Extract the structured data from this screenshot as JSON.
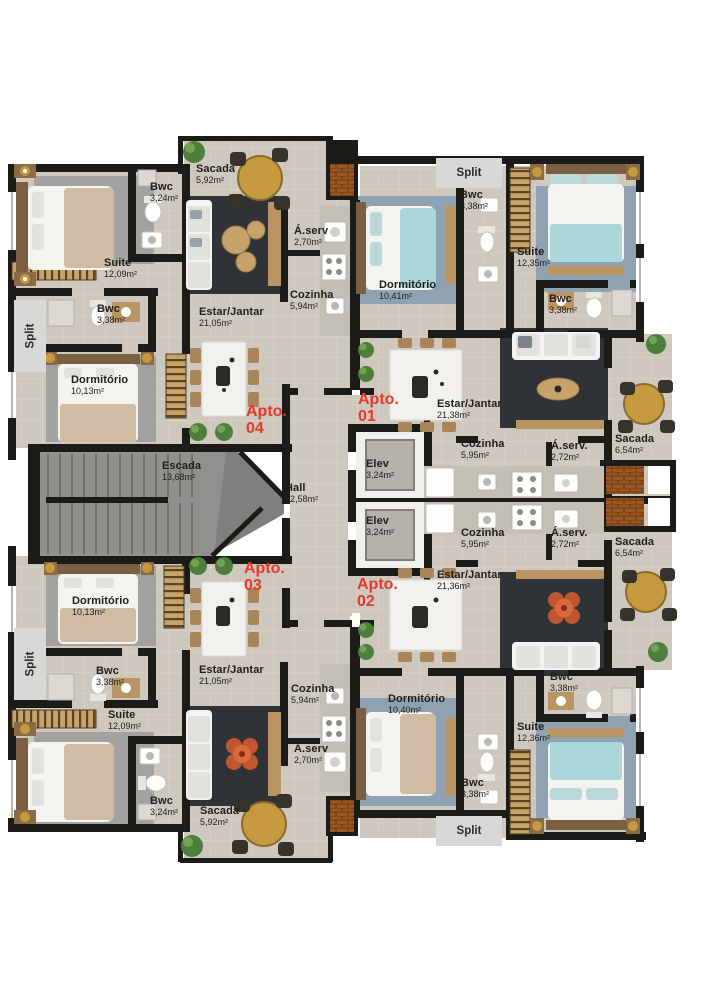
{
  "plan_type": "residential-floor-plan",
  "colors": {
    "wall": "#1b1b18",
    "floor": "#cdc7bd",
    "floor_line": "#dad4ca",
    "accent_red": "#e8372b",
    "living_rug": "#2f3237",
    "bedroom_rug_gray": "#a2a3a0",
    "bedroom_rug_steel": "#8fa2b1",
    "wood": "#b99563",
    "gold": "#c59a3f",
    "teal_bed": "#abd7da",
    "tan_bed": "#cfbca3",
    "stair_gray": "#8e918d",
    "split_box": "#d8d8d6",
    "brick": "#9a5724"
  },
  "apartment_labels": [
    {
      "t": "Apto.",
      "n": "04",
      "x": 246,
      "y": 404
    },
    {
      "t": "Apto.",
      "n": "01",
      "x": 358,
      "y": 392
    },
    {
      "t": "Apto.",
      "n": "03",
      "x": 244,
      "y": 561
    },
    {
      "t": "Apto.",
      "n": "02",
      "x": 357,
      "y": 577
    }
  ],
  "room_labels": [
    {
      "t": "Sacada",
      "a": "5,92m²",
      "x": 196,
      "y": 164
    },
    {
      "t": "Bwc",
      "a": "3,24m²",
      "x": 150,
      "y": 182
    },
    {
      "t": "Suite",
      "a": "12,09m²",
      "x": 104,
      "y": 258
    },
    {
      "t": "Á.serv",
      "a": "2,70m²",
      "x": 294,
      "y": 226
    },
    {
      "t": "Cozinha",
      "a": "5,94m²",
      "x": 290,
      "y": 290
    },
    {
      "t": "Bwc",
      "a": "3,38m²",
      "x": 97,
      "y": 304
    },
    {
      "t": "Estar/Jantar",
      "a": "21,05m²",
      "x": 199,
      "y": 307
    },
    {
      "t": "Dormitório",
      "a": "10,13m²",
      "x": 71,
      "y": 375
    },
    {
      "t": "Escada",
      "a": "13,68m²",
      "x": 162,
      "y": 461
    },
    {
      "t": "Hall",
      "a": "12,58m²",
      "x": 285,
      "y": 483
    },
    {
      "t": "Elev",
      "a": "3,24m²",
      "x": 366,
      "y": 459
    },
    {
      "t": "Elev",
      "a": "3,24m²",
      "x": 366,
      "y": 516
    },
    {
      "t": "Bwc",
      "a": "3,38m²",
      "x": 460,
      "y": 190
    },
    {
      "t": "Suite",
      "a": "12,35m²",
      "x": 517,
      "y": 247
    },
    {
      "t": "Dormitório",
      "a": "10,41m²",
      "x": 379,
      "y": 280
    },
    {
      "t": "Bwc",
      "a": "3,38m²",
      "x": 549,
      "y": 294
    },
    {
      "t": "Estar/Jantar",
      "a": "21,38m²",
      "x": 437,
      "y": 399
    },
    {
      "t": "Cozinha",
      "a": "5,95m²",
      "x": 461,
      "y": 439
    },
    {
      "t": "Á.serv.",
      "a": "2,72m²",
      "x": 551,
      "y": 441
    },
    {
      "t": "Sacada",
      "a": "6,54m²",
      "x": 615,
      "y": 434
    },
    {
      "t": "Cozinha",
      "a": "5,95m²",
      "x": 461,
      "y": 528
    },
    {
      "t": "Á.serv.",
      "a": "2,72m²",
      "x": 551,
      "y": 528
    },
    {
      "t": "Sacada",
      "a": "6,54m²",
      "x": 615,
      "y": 537
    },
    {
      "t": "Estar/Jantar",
      "a": "21,36m²",
      "x": 437,
      "y": 570
    },
    {
      "t": "Bwc",
      "a": "3,38m²",
      "x": 550,
      "y": 672
    },
    {
      "t": "Dormitório",
      "a": "10,40m²",
      "x": 388,
      "y": 694
    },
    {
      "t": "Suite",
      "a": "12,36m²",
      "x": 517,
      "y": 722
    },
    {
      "t": "Bwc",
      "a": "3,38m²",
      "x": 461,
      "y": 778
    },
    {
      "t": "Dormitório",
      "a": "10,13m²",
      "x": 72,
      "y": 596
    },
    {
      "t": "Bwc",
      "a": "3,38m²",
      "x": 96,
      "y": 666
    },
    {
      "t": "Suite",
      "a": "12,09m²",
      "x": 108,
      "y": 710
    },
    {
      "t": "Estar/Jantar",
      "a": "21,05m²",
      "x": 199,
      "y": 665
    },
    {
      "t": "Cozinha",
      "a": "5,94m²",
      "x": 291,
      "y": 684
    },
    {
      "t": "Á.serv",
      "a": "2,70m²",
      "x": 294,
      "y": 744
    },
    {
      "t": "Bwc",
      "a": "3,24m²",
      "x": 150,
      "y": 796
    },
    {
      "t": "Sacada",
      "a": "5,92m²",
      "x": 200,
      "y": 806
    }
  ],
  "split_labels": [
    {
      "t": "Split",
      "x": 14,
      "y": 300,
      "w": 32,
      "h": 72,
      "v": true
    },
    {
      "t": "Split",
      "x": 14,
      "y": 628,
      "w": 32,
      "h": 72,
      "v": true
    },
    {
      "t": "Split",
      "x": 436,
      "y": 158,
      "w": 66,
      "h": 30,
      "v": false
    },
    {
      "t": "Split",
      "x": 436,
      "y": 816,
      "w": 66,
      "h": 30,
      "v": false
    }
  ]
}
